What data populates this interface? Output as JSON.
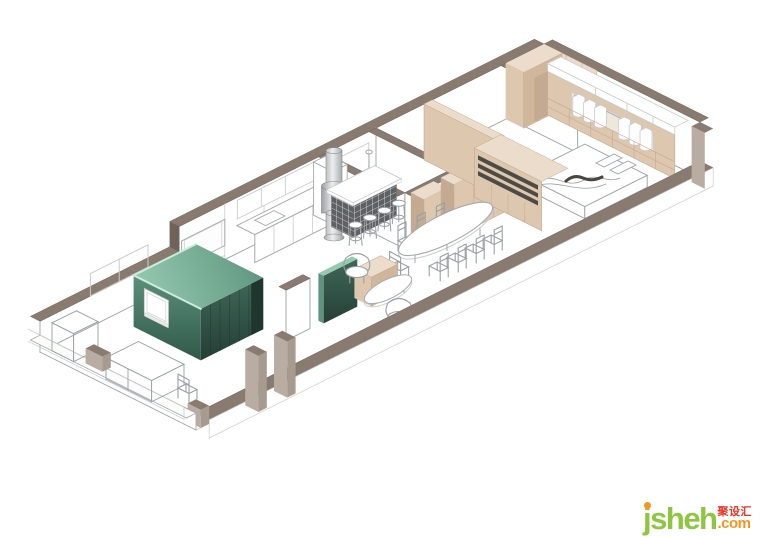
{
  "watermark": {
    "brand": "jsheh",
    "suffix": ".com",
    "cjk": "聚设汇"
  },
  "palette": {
    "cap": "#8a7b71",
    "capEdge": "#6f6359",
    "line": "#a6a9ac",
    "lineSoft": "#c9cccd",
    "ink": "#9aa0a3",
    "beige": "#ddc7af",
    "beigeLight": "#ecdccb",
    "beigeMid": "#d0b79c",
    "beigeDark": "#c3aa90",
    "interior": "#efe7db",
    "slot": "#4e4b45",
    "itemDark": "#4a463f",
    "greenTopA": "#96c9b0",
    "greenTopB": "#5e957f",
    "greenSWA": "#5e937e",
    "greenSWB": "#2f5747",
    "greenSEA": "#40695a",
    "greenSEB": "#253e35",
    "greenDeep": "#1f362e",
    "greenHi": "#cdeadd",
    "steelA": "#9a9ea1",
    "steelB": "#eceeef",
    "steelC": "#85888b",
    "tile": "#5d6164",
    "tileLine": "#f2f2f1",
    "postLight": "#b9ada3",
    "postDark": "#a79a8f",
    "brandGreen": "#8dc63f",
    "brandOrange": "#f7941d",
    "brandRed": "#ee3424"
  },
  "scene": {
    "style": "isometric line rendering of an apartment interior",
    "elements": [
      "perimeter walls with taupe cut caps",
      "balcony entry with bench outlines",
      "green pod room with window",
      "green panel wall",
      "beige sideboard",
      "tv panel on wall",
      "kitchen counter with sink",
      "stainless range-hood column",
      "dark tiled bar counter",
      "bar stools",
      "oval dining table",
      "dining chairs",
      "armchairs",
      "round coffee table",
      "bathroom with mirrors and shower",
      "hallway tall cabinets",
      "display shelf cabinet",
      "bedroom partition",
      "bed with blanket",
      "wardrobe with hanging clothes",
      "closet shelf boxes"
    ]
  }
}
